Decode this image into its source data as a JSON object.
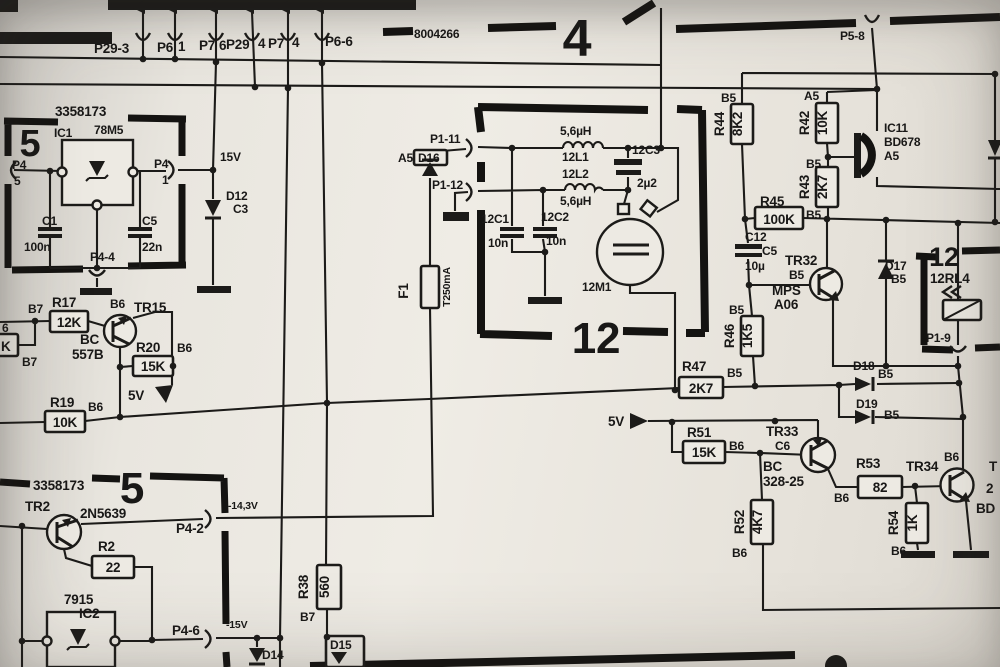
{
  "sheet": {
    "part_top": "8004266",
    "block4": "4",
    "block5a": "5",
    "block5b": "5",
    "block12": "12",
    "relay12": "12",
    "mod_a": "3358173",
    "mod_b": "3358173"
  },
  "connectors": {
    "p29_3": "P29-3",
    "p6_top": "P6",
    "p6_top_pin": "1",
    "p7_a": "P7",
    "p7_a_pin": "6",
    "p29_b": "P29",
    "p29_b_pin": "4",
    "p7_b": "P7",
    "p7_b_pin": "4",
    "p6_6": "P6-6",
    "p5_8": "P5-8",
    "p4_5": "P4",
    "p4_5_pin": "5",
    "p4_1": "P4",
    "p4_1_pin": "1",
    "p4_4": "P4-4",
    "p4_2": "P4-2",
    "p4_6": "P4-6",
    "p1_11": "P1-11",
    "p1_12": "P1-12",
    "p1_9": "P1-9"
  },
  "rails": {
    "v15": "15V",
    "v5_left": "5V",
    "v5_right": "5V",
    "vn14": "-14,3V",
    "vn15": "-15V"
  },
  "ics": {
    "ic1_ref": "IC1",
    "ic1_val": "78M5",
    "ic2_val": "7915",
    "ic2_ref": "IC2",
    "ic11_ref": "IC11",
    "ic11_val": "BD678",
    "ic11_grp": "A5"
  },
  "transistors": {
    "tr15_ref": "TR15",
    "tr15_grp": "B6",
    "tr15_val1": "BC",
    "tr15_val2": "557B",
    "tr2_ref": "TR2",
    "tr2_val": "2N5639",
    "tr32_ref": "TR32",
    "tr32_grp": "B5",
    "tr32_val1": "MPS",
    "tr32_val2": "A06",
    "tr33_ref": "TR33",
    "tr33_grp": "C6",
    "tr33_val1": "BC",
    "tr33_val2": "328-25",
    "tr34_ref": "TR34",
    "tr34_grp": "B6"
  },
  "resistors": {
    "r17": {
      "ref": "R17",
      "val": "12K",
      "tag": "B7"
    },
    "r20": {
      "ref": "R20",
      "val": "15K",
      "tag": "B6"
    },
    "r19": {
      "ref": "R19",
      "val": "10K",
      "tag": "B6"
    },
    "r2": {
      "ref": "R2",
      "val": "22"
    },
    "r38": {
      "ref": "R38",
      "val": "560",
      "tag": "B7"
    },
    "r44": {
      "ref": "R44",
      "val": "8K2",
      "tag": "B5"
    },
    "r42": {
      "ref": "R42",
      "val": "10K",
      "tag": "A5"
    },
    "r43": {
      "ref": "R43",
      "val": "2K7",
      "tag": "B5"
    },
    "r45": {
      "ref": "R45",
      "val": "100K",
      "tag": "B5"
    },
    "r46": {
      "ref": "R46",
      "val": "1K5",
      "tag": "B5"
    },
    "r47": {
      "ref": "R47",
      "val": "2K7",
      "tag": "B5"
    },
    "r51": {
      "ref": "R51",
      "val": "15K",
      "tag": "B6"
    },
    "r52": {
      "ref": "R52",
      "val": "4K7",
      "tag": "B6"
    },
    "r53": {
      "ref": "R53",
      "val": "82",
      "tag": "B6"
    },
    "r54": {
      "ref": "R54",
      "val": "1K",
      "tag": "B6"
    },
    "partial": {
      "l1": "6",
      "l2": "K",
      "tag": "B7"
    }
  },
  "capacitors": {
    "c1": "C1",
    "c1v": "100n",
    "c5": "C5",
    "c5v": "22n",
    "c12a": "C12",
    "c12b": "C5",
    "c12v": "10µ",
    "c121": "12C1",
    "c121v": "10n",
    "c122": "12C2",
    "c122v": "10n",
    "c123": "12C3",
    "c123v": "2µ2"
  },
  "inductors": {
    "l1": "12L1",
    "l1v": "5,6µH",
    "l2": "12L2",
    "l2v": "5,6µH"
  },
  "diodes": {
    "d12": "D12",
    "d12t": "C3",
    "d14": "D14",
    "d15": "D15",
    "d16": "D16",
    "d16t": "A5",
    "d17": "D17",
    "d17t": "B5",
    "d18": "D18",
    "d18t": "B5",
    "d19": "D19",
    "d19t": "B5"
  },
  "misc": {
    "fuse_ref": "F1",
    "fuse_val": "T250mA",
    "motor": "12M1",
    "relay": "12RL4",
    "frag_t": "T",
    "frag_2": "2",
    "frag_bd": "BD"
  }
}
